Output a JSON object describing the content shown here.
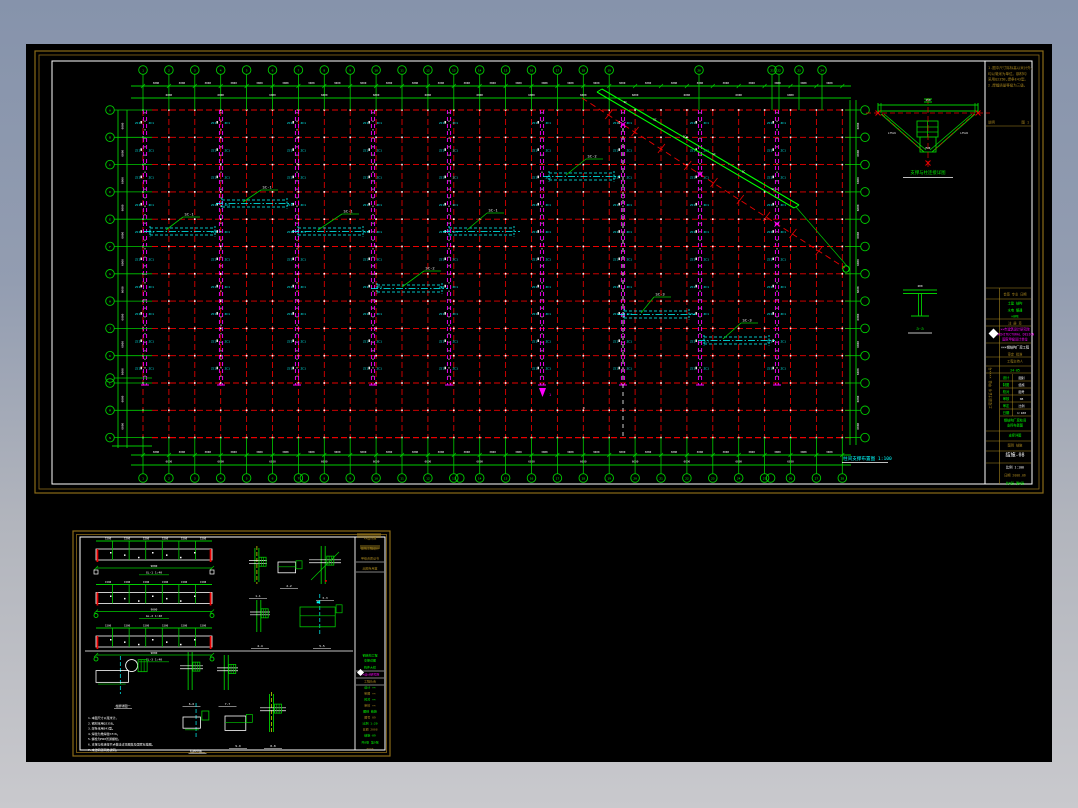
{
  "colors": {
    "bg_top": "#8693ab",
    "bg_bottom": "#c9c9cd",
    "black": "#000000",
    "sheet_border": "#8a6a18",
    "red": "#e80000",
    "green": "#00cc00",
    "bright_green": "#00ff00",
    "magenta": "#ff00ff",
    "cyan": "#00ffff",
    "white": "#ffffff",
    "gold": "#a8861e",
    "yellow": "#e8e800"
  },
  "main_sheet": {
    "plan_title": "柱间支撑布置图 1:100",
    "grid": {
      "col_start": 143,
      "col_step": 25.9,
      "col_count": 28,
      "row_start": 110,
      "row_step": 27.3,
      "row_count": 13,
      "magenta_cols": [
        145,
        221,
        297,
        373,
        449,
        542,
        623,
        700,
        777
      ],
      "white_dash_col": 623,
      "col_bubble_labels": [
        "1",
        "2",
        "3",
        "4",
        "5",
        "6",
        "7",
        "8",
        "9",
        "10",
        "11",
        "12",
        "13",
        "14",
        "15",
        "16",
        "17",
        "18",
        "19"
      ],
      "extra_top_bubbles": [
        {
          "x": 699,
          "label": "20"
        },
        {
          "x": 772,
          "label": "21"
        },
        {
          "x": 779,
          "label": "22"
        },
        {
          "x": 799,
          "label": "23"
        },
        {
          "x": 822,
          "label": "24"
        }
      ],
      "row_bubble_labels": [
        "A",
        "B",
        "C",
        "D",
        "E",
        "F",
        "G",
        "H",
        "J",
        "K",
        "L",
        "M",
        "N"
      ],
      "twin_bottom_idx": [
        6,
        12,
        24
      ],
      "seg_dim": "3000",
      "bay_dim": "6000",
      "side_dim": "6000",
      "col_tag": "ZC1"
    },
    "cyan_beams": [
      [
        150,
        228
      ],
      [
        222,
        200
      ],
      [
        298,
        228
      ],
      [
        377,
        285
      ],
      [
        449,
        228
      ],
      [
        549,
        173
      ],
      [
        624,
        311
      ],
      [
        704,
        337
      ]
    ],
    "beam_span": 65,
    "beam_labels": [
      {
        "lx": 166,
        "ly": 230,
        "tx": 183,
        "ty": 217,
        "t": "SC-1"
      },
      {
        "lx": 243,
        "ly": 202,
        "tx": 261,
        "ty": 190,
        "t": "SC-1"
      },
      {
        "lx": 318,
        "ly": 230,
        "tx": 342,
        "ty": 214,
        "t": "SC-1"
      },
      {
        "lx": 402,
        "ly": 287,
        "tx": 424,
        "ty": 271,
        "t": "SC-2"
      },
      {
        "lx": 467,
        "ly": 230,
        "tx": 487,
        "ty": 213,
        "t": "SC-1"
      },
      {
        "lx": 566,
        "ly": 175,
        "tx": 586,
        "ty": 159,
        "t": "SC-2"
      },
      {
        "lx": 641,
        "ly": 313,
        "tx": 654,
        "ty": 297,
        "t": "SC-3"
      },
      {
        "lx": 723,
        "ly": 339,
        "tx": 741,
        "ty": 323,
        "t": "SC-3"
      }
    ],
    "diagonal": {
      "x1": 597,
      "y1": 92,
      "x2": 794,
      "y2": 208,
      "rx1": 582,
      "ry1": 98,
      "rx2": 845,
      "ry2": 268,
      "tag": "SC"
    },
    "truss_detail": {
      "x": 878,
      "y": 105,
      "w": 100,
      "label": "支撑与柱连接详图",
      "dim_top": "250",
      "dim_l": "L75×6",
      "dim_r": "L75×6",
      "dim_c": "M20"
    },
    "section_detail": {
      "x": 903,
      "y": 290,
      "label": "a-a",
      "dim": "200"
    },
    "section_mark": {
      "x": 542,
      "y": 390,
      "t": "1"
    },
    "titleblock": {
      "notes": [
        "1.图中尺寸除标高以米计外,",
        "  均以毫米为单位。钢材均",
        "  采用Q235B,焊条E43型。",
        "2.焊缝质量等级为三级。"
      ],
      "notes_footer_left": "说明",
      "notes_footer_right": "图 1",
      "side_text": "工程设计证书 甲级 ××××号",
      "rows": [
        {
          "y": 291,
          "h": 8,
          "c": "gold",
          "t": "会签 专业 日期",
          "line": 1
        },
        {
          "y": 300,
          "h": 7,
          "c": "green",
          "t": "土建  结构",
          "line": 0
        },
        {
          "y": 307,
          "h": 6,
          "c": "green",
          "t": "水电  暖通",
          "line": 0
        },
        {
          "y": 313,
          "h": 6,
          "c": "green",
          "t": "×0#E",
          "line": 1
        },
        {
          "y": 320,
          "h": 6,
          "c": "gold",
          "t": "注 册 章",
          "line": 1
        },
        {
          "y": 326,
          "h": 17,
          "c": "magenta",
          "t": "××市建筑设计研究院|ARCHITECTURAL DESIGN|国家甲级设计单位",
          "line": 1,
          "logo": 1
        },
        {
          "y": 344,
          "h": 7,
          "c": "white",
          "t": "×××钢结构厂房工程",
          "line": 0
        },
        {
          "y": 351,
          "h": 6,
          "c": "gold",
          "t": "审定  批准",
          "line": 1
        },
        {
          "y": 358,
          "h": 8,
          "c": "gold",
          "t": "工程主持人",
          "line": 1
        },
        {
          "y": 367,
          "h": 6,
          "c": "green",
          "t": "24-05",
          "line": 1
        }
      ],
      "table_y": 374,
      "table_row_h": 7,
      "table": [
        {
          "l": "设计",
          "r": "图别"
        },
        {
          "l": "制图",
          "r": "结施"
        },
        {
          "l": "校对",
          "r": "图号"
        },
        {
          "l": "审核",
          "r": "08"
        },
        {
          "l": "审定",
          "r": "比例"
        },
        {
          "l": "日期",
          "r": "1:100"
        }
      ],
      "rows_bottom": [
        {
          "y": 417,
          "h": 14,
          "c": "green",
          "t": "钢结构厂房柱间|支撑布置图",
          "line": 1
        },
        {
          "y": 432,
          "h": 9,
          "c": "green",
          "t": "支撑详图",
          "line": 1
        },
        {
          "y": 442,
          "h": 9,
          "c": "gold",
          "t": "图别  结施",
          "line": 1
        },
        {
          "y": 452,
          "h": 11,
          "c": "white",
          "t": "结施-08",
          "fs": 5,
          "line": 1
        },
        {
          "y": 464,
          "h": 8,
          "c": "white",
          "t": "比例 1:100",
          "line": 0
        },
        {
          "y": 472,
          "h": 8,
          "c": "gold",
          "t": "日期 2008.06",
          "line": 0
        },
        {
          "y": 480,
          "h": 8,
          "c": "green",
          "t": "共8张 第8张",
          "line": 0
        }
      ]
    }
  },
  "detail_sheet": {
    "beams": {
      "x": 96,
      "w": 116,
      "tops": [
        541,
        584.5,
        628
      ],
      "labels": [
        "GL-1 1:40",
        "GL-2 1:40",
        "GL-3 1:40"
      ],
      "dim": "9000",
      "seg_dim": "1500"
    },
    "divider_y": 651,
    "details": [
      {
        "x": 247,
        "y": 548,
        "w": 22,
        "h": 42,
        "label": "1-1",
        "cl": "yellow",
        "type": "col"
      },
      {
        "x": 278,
        "y": 556,
        "w": 22,
        "h": 24,
        "label": "2-2",
        "cl": null,
        "type": "plate"
      },
      {
        "x": 307,
        "y": 546,
        "w": 36,
        "h": 46,
        "label": "3-3",
        "cl": null,
        "type": "col2"
      },
      {
        "x": 248,
        "y": 600,
        "w": 24,
        "h": 40,
        "label": "4-4",
        "cl": null,
        "type": "col"
      },
      {
        "x": 300,
        "y": 596,
        "w": 44,
        "h": 44,
        "label": "5-5",
        "cl": "cyan",
        "type": "plate2"
      },
      {
        "x": 96,
        "y": 658,
        "w": 54,
        "h": 42,
        "label": "柱脚详图一",
        "cl": "cyan",
        "type": "base"
      },
      {
        "x": 178,
        "y": 652,
        "w": 27,
        "h": 46,
        "label": "6-6",
        "cl": null,
        "type": "col"
      },
      {
        "x": 215,
        "y": 655,
        "w": 25,
        "h": 43,
        "label": "7-7",
        "cl": null,
        "type": "col"
      },
      {
        "x": 183,
        "y": 705,
        "w": 29,
        "h": 40,
        "label": "柱脚详图二",
        "cl": "cyan",
        "type": "base2"
      },
      {
        "x": 258,
        "y": 694,
        "w": 30,
        "h": 46,
        "label": "8-8",
        "cl": "yellow",
        "type": "col"
      },
      {
        "x": 225,
        "y": 708,
        "w": 26,
        "h": 32,
        "label": "9-9",
        "cl": null,
        "type": "plate"
      }
    ],
    "notes": [
      "1.本图尺寸以毫米计。",
      "2.钢材采用Q235B。",
      "3.焊条采用E43型。",
      "4.焊缝为角焊缝hf=6。",
      "5.螺栓为M20普通螺栓。",
      "6.支撑与柱连接节点做法详见图集及国家标准图。",
      "7.未注明者同总说明。"
    ],
    "titleblock_rows": [
      {
        "y": 533,
        "h": 8,
        "c": "gold",
        "t": "××设计院",
        "line": 0
      },
      {
        "y": 541,
        "h": 10,
        "c": "gold",
        "t": "建筑工程设计",
        "line": 0
      },
      {
        "y": 552,
        "h": 9,
        "c": "gold",
        "t": "甲级资质证书",
        "line": 1
      },
      {
        "y": 563,
        "h": 8,
        "c": "gold",
        "t": "出图专用章",
        "line": 1
      },
      {
        "y": 652,
        "h": 6,
        "c": "green",
        "t": "钢结构工程",
        "line": 0
      },
      {
        "y": 658,
        "h": 5,
        "c": "green",
        "t": "支撑详图",
        "line": 0
      },
      {
        "y": 664,
        "h": 6,
        "c": "green",
        "t": "构件大样",
        "line": 1
      },
      {
        "y": 670,
        "h": 7,
        "c": "magenta",
        "t": "××设计研究院",
        "line": 1,
        "logo": 1
      },
      {
        "y": 678,
        "h": 6,
        "c": "gold",
        "t": "工程负责",
        "line": 1
      },
      {
        "y": 685,
        "h": 5,
        "c": "green",
        "t": "设计 ××",
        "line": 0
      },
      {
        "y": 691,
        "h": 5,
        "c": "gold",
        "t": "制图 ××",
        "line": 0
      },
      {
        "y": 697,
        "h": 5,
        "c": "green",
        "t": "校对 ××",
        "line": 0
      },
      {
        "y": 703,
        "h": 5,
        "c": "gold",
        "t": "审核 ××",
        "line": 0
      },
      {
        "y": 709,
        "h": 5,
        "c": "green",
        "t": "图别 结施",
        "line": 0
      },
      {
        "y": 715,
        "h": 5,
        "c": "gold",
        "t": "图号 09",
        "line": 0
      },
      {
        "y": 721,
        "h": 5,
        "c": "green",
        "t": "比例 1:20",
        "line": 0
      },
      {
        "y": 727,
        "h": 5,
        "c": "gold",
        "t": "日期 2008",
        "line": 0
      },
      {
        "y": 733,
        "h": 5,
        "c": "green",
        "t": "结施-09",
        "line": 0
      },
      {
        "y": 739,
        "h": 6,
        "c": "green",
        "t": "共8张 第9张",
        "line": 0
      },
      {
        "y": 746,
        "h": 5,
        "c": "gold",
        "t": "××××",
        "line": 0
      }
    ]
  }
}
